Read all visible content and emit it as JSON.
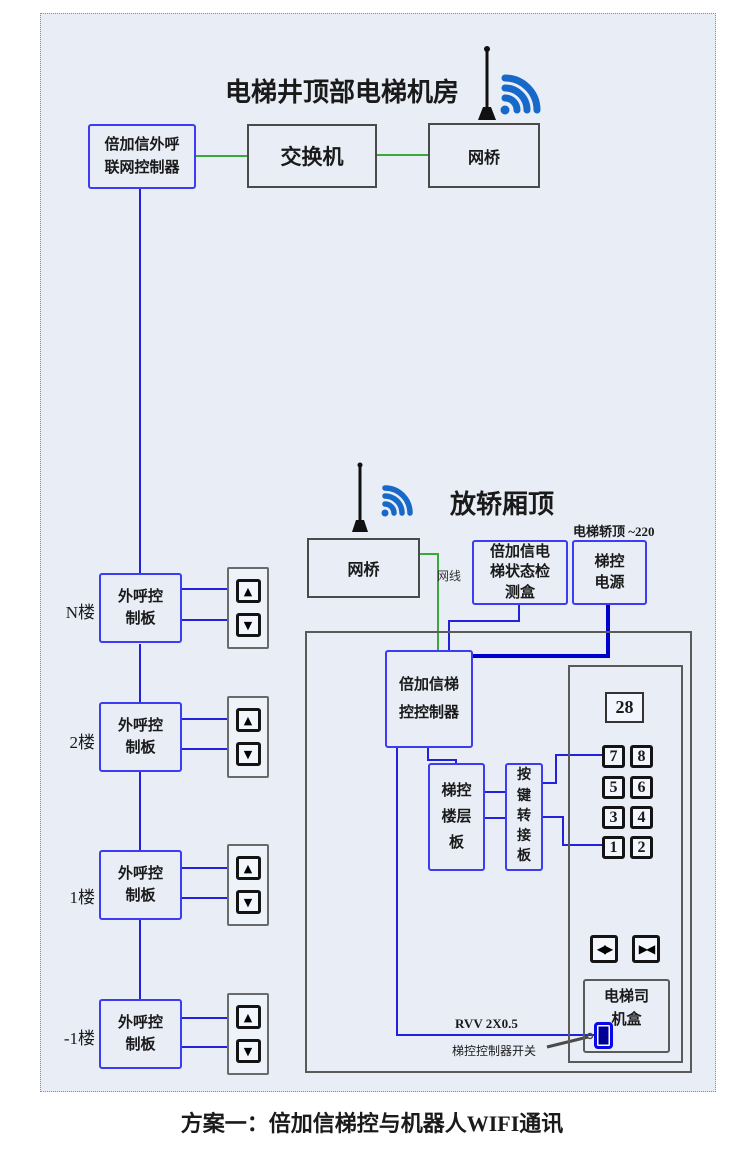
{
  "caption": "方案一：倍加信梯控与机器人WIFI通讯",
  "machine_room": {
    "title": "电梯井顶部电梯机房",
    "controller_label": "倍加信外呼\n联网控制器",
    "switch_label": "交换机",
    "bridge_label": "网桥"
  },
  "hoistway": {
    "floors": [
      {
        "floor": "N楼",
        "board": "外呼控\n制板"
      },
      {
        "floor": "2楼",
        "board": "外呼控\n制板"
      },
      {
        "floor": "1楼",
        "board": "外呼控\n制板"
      },
      {
        "floor": "-1楼",
        "board": "外呼控\n制板"
      }
    ]
  },
  "car_top": {
    "title": "放轿厢顶",
    "power_note": "电梯轿顶 ~220",
    "bridge_label": "网桥",
    "network_cable_label": "网线",
    "status_box_label": "倍加信电\n梯状态检\n测盒",
    "power_label": "梯控\n电源",
    "controller_label": "倍加信梯\n控控制器",
    "floor_board_label": "梯控\n楼层\n板",
    "key_adapter_label": "按\n键\n转\n接\n板",
    "display_value": "28",
    "floor_buttons": [
      "7",
      "8",
      "5",
      "6",
      "3",
      "4",
      "1",
      "2"
    ],
    "driver_box_label": "电梯司\n机盒",
    "cable_label": "RVV 2X0.5",
    "switch_note": "梯控控制器开关"
  },
  "icons": {
    "up": "▲",
    "down": "▼",
    "door_open": "◀▶",
    "door_close": "▶◀"
  },
  "colors": {
    "background": "#e8edf6",
    "blue_box_border": "#3c3cf2",
    "dark_box_border": "#4a4a4a",
    "green_cable": "#3aa83a",
    "blue_cable": "#2222dd",
    "power_cable": "#0000cc",
    "wifi_blue": "#1669c9"
  }
}
